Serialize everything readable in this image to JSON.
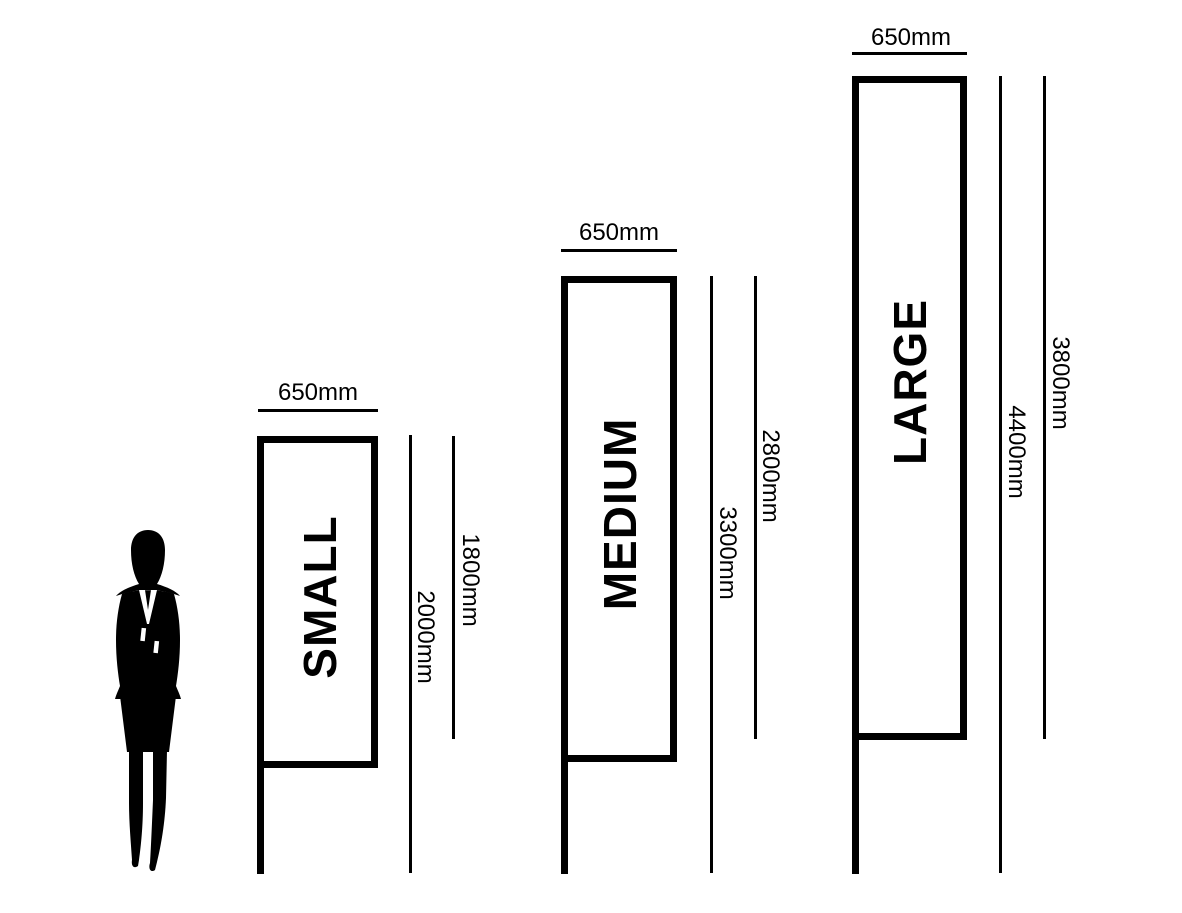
{
  "colors": {
    "ink": "#000000",
    "background": "#ffffff"
  },
  "figure": {
    "icon": "businesswoman-silhouette-icon"
  },
  "sizes": [
    {
      "id": "small",
      "name": "SMALL",
      "width": "650mm",
      "banner_height": "1800mm",
      "total_height": "2000mm",
      "width_mm": 650,
      "banner_height_mm": 1800,
      "total_height_mm": 2000
    },
    {
      "id": "medium",
      "name": "MEDIUM",
      "width": "650mm",
      "banner_height": "2800mm",
      "total_height": "3300mm",
      "width_mm": 650,
      "banner_height_mm": 2800,
      "total_height_mm": 3300
    },
    {
      "id": "large",
      "name": "LARGE",
      "width": "650mm",
      "banner_height": "3800mm",
      "total_height": "4400mm",
      "width_mm": 650,
      "banner_height_mm": 3800,
      "total_height_mm": 4400
    }
  ]
}
